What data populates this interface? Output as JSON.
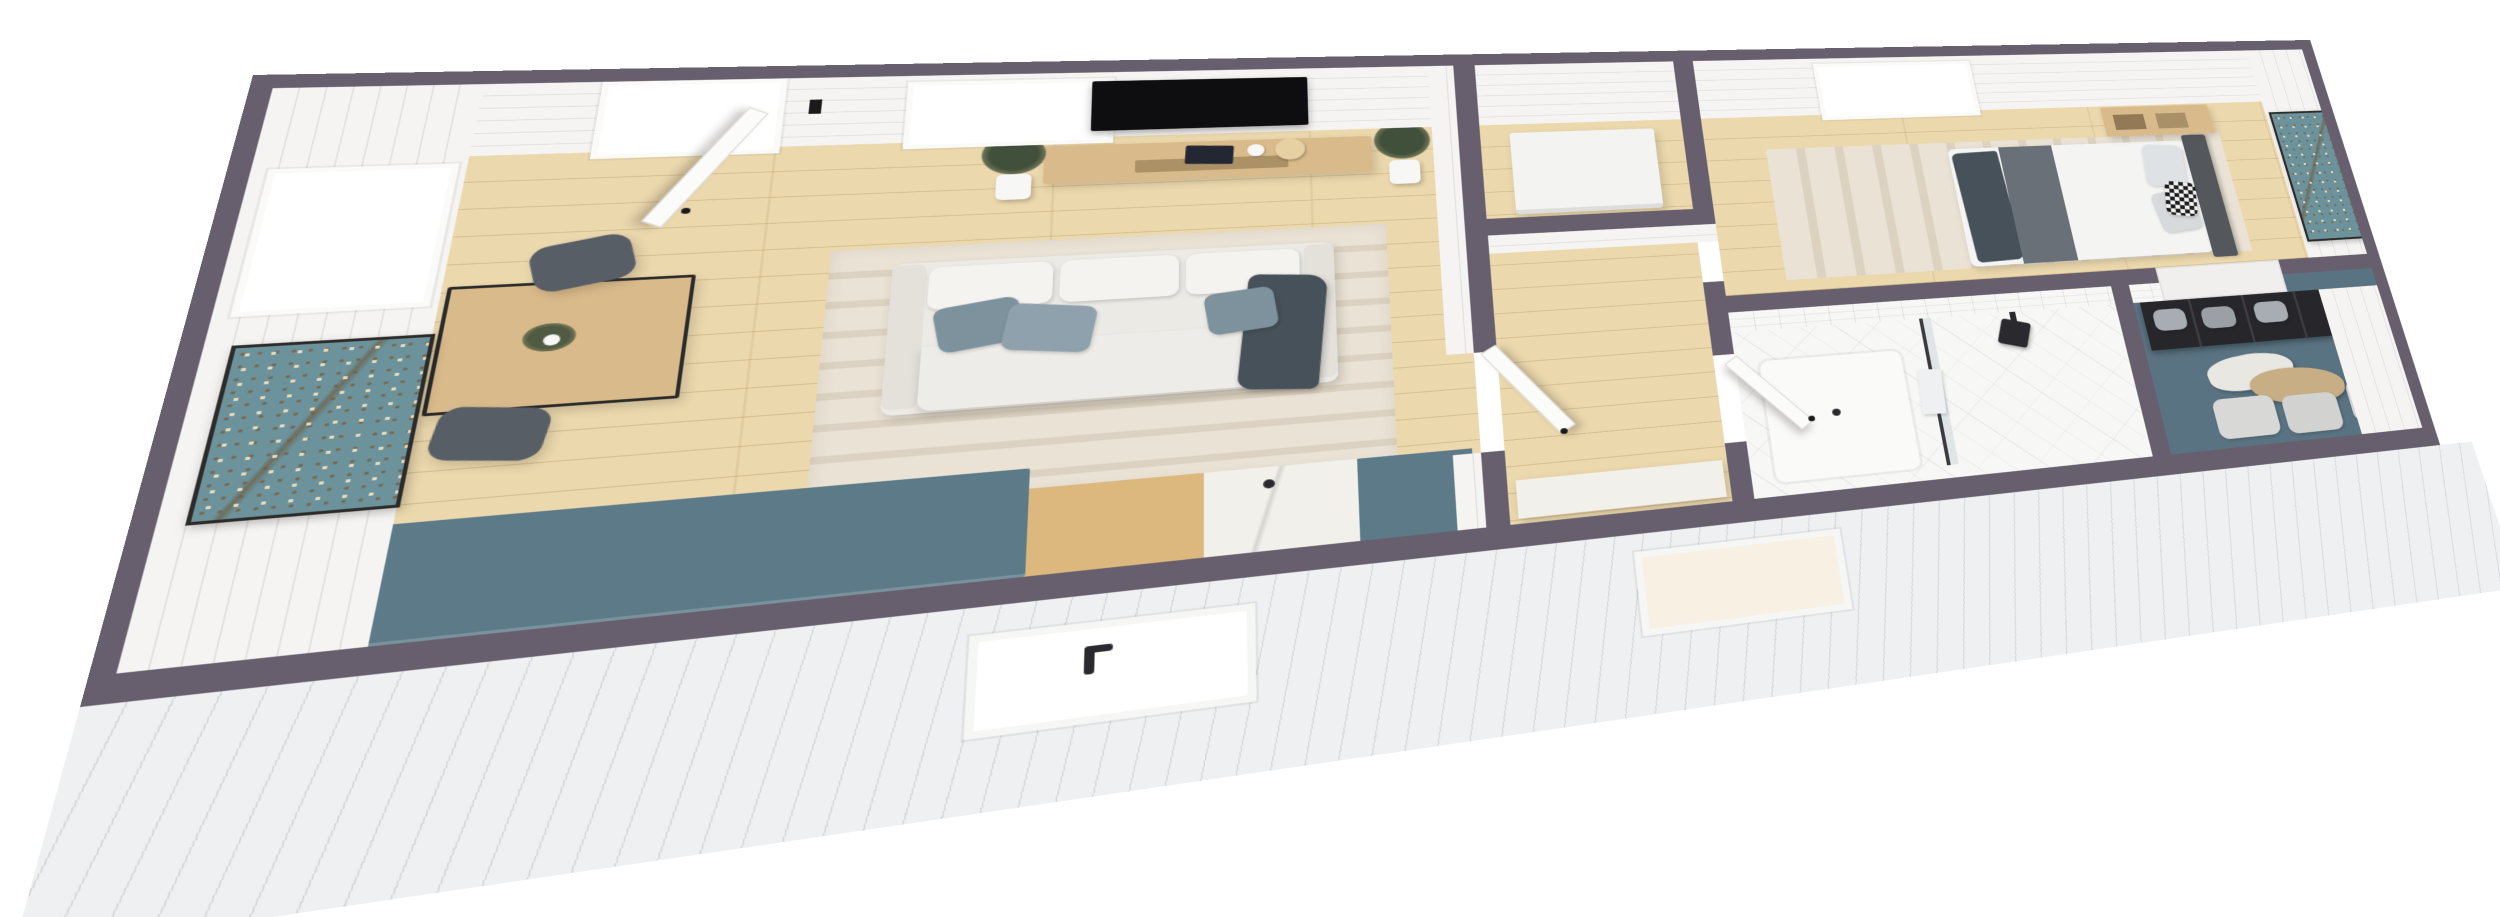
{
  "meta": {
    "description": "3D isometric dollhouse-style rendering of a one-bedroom tiny home floor plan on a white background",
    "text_on_screen": "none"
  },
  "colors": {
    "wall_cap": "#675f6d",
    "wall_face": "#f5f4f2",
    "floor_wood": "#ebd8ad",
    "siding": "#eef0f2",
    "counter_teal": "#5d7a88",
    "counter_wood": "#dcb87e",
    "counter_marble": "#f2f0ea",
    "sofa_body": "#eceae5",
    "cushion_white": "#f5f3f0",
    "pillow_blue": "#7e929e",
    "pillow_blue_light": "#8fa1ac",
    "throw_dark": "#47515a",
    "rug_beige": "#e9e2d5",
    "rug_stripe": "#dcd2c1",
    "art_teal": "#6c929b",
    "tv_black": "#0e0e10",
    "console_wood": "#d9ba8b",
    "plant_green": "#41503a",
    "pot_white": "#f7f7f5",
    "chair_gray": "#585e66",
    "bed_headboard": "#54585c",
    "bed_runner": "#6a7077",
    "bedding_white": "#f4f4f3",
    "tile_white": "#f7f7f5",
    "closet_teal": "#5a7382",
    "wardrobe_dark": "#27272b",
    "bin_gray": "#a7adb3",
    "ottoman_gray": "#d8d8d6",
    "clothes_tan": "#c8ae84",
    "appliance_white": "#f3f3f2",
    "glass_pane": "rgba(190,205,212,0.4)",
    "fixture_black": "#2a2a2e",
    "window_white": "#ffffff",
    "window_warm": "#f7f0e3"
  },
  "scene": {
    "view": "isometric top-down cutaway (dollhouse) floor plan",
    "rooms": [
      {
        "name": "living-room",
        "contents": [
          "open-entry-door",
          "back-wall-window",
          "left-wall-window",
          "wall-art-almond-blossom",
          "tv",
          "media-console",
          "console-decor",
          "potted-plant-left",
          "potted-plant-right",
          "striped-area-rug",
          "white-sofa",
          "blue-gray-pillows",
          "dark-throw-blanket",
          "wood-dining-table",
          "gray-chair-upper",
          "gray-chair-lower",
          "table-plant"
        ]
      },
      {
        "name": "kitchen",
        "contents": [
          "teal-l-counter",
          "butcher-block-counter",
          "marble-counter",
          "teal-island-section",
          "sink-faucet",
          "kitchen-window-exterior"
        ]
      },
      {
        "name": "utility-closet",
        "contents": [
          "white-appliance"
        ]
      },
      {
        "name": "hallway",
        "contents": [
          "interior-door-ajar",
          "marble-storage-cabinet"
        ]
      },
      {
        "name": "bedroom",
        "contents": [
          "back-wall-window",
          "double-bed",
          "dark-headboard",
          "gray-pillows",
          "checkered-pillow",
          "bed-runner",
          "foot-throw",
          "wood-bedside-shelf",
          "wall-art-almond-blossom",
          "area-rug"
        ]
      },
      {
        "name": "bathroom",
        "contents": [
          "open-door",
          "subway-tile-wall",
          "rain-shower-head",
          "glass-shower-panel",
          "shower-tray",
          "towel",
          "bathroom-window-exterior"
        ]
      },
      {
        "name": "walk-in-closet",
        "contents": [
          "dark-wardrobe",
          "gray-storage-bins",
          "hanging-clothes",
          "stacked-ottomans",
          "teal-walls"
        ]
      }
    ]
  }
}
